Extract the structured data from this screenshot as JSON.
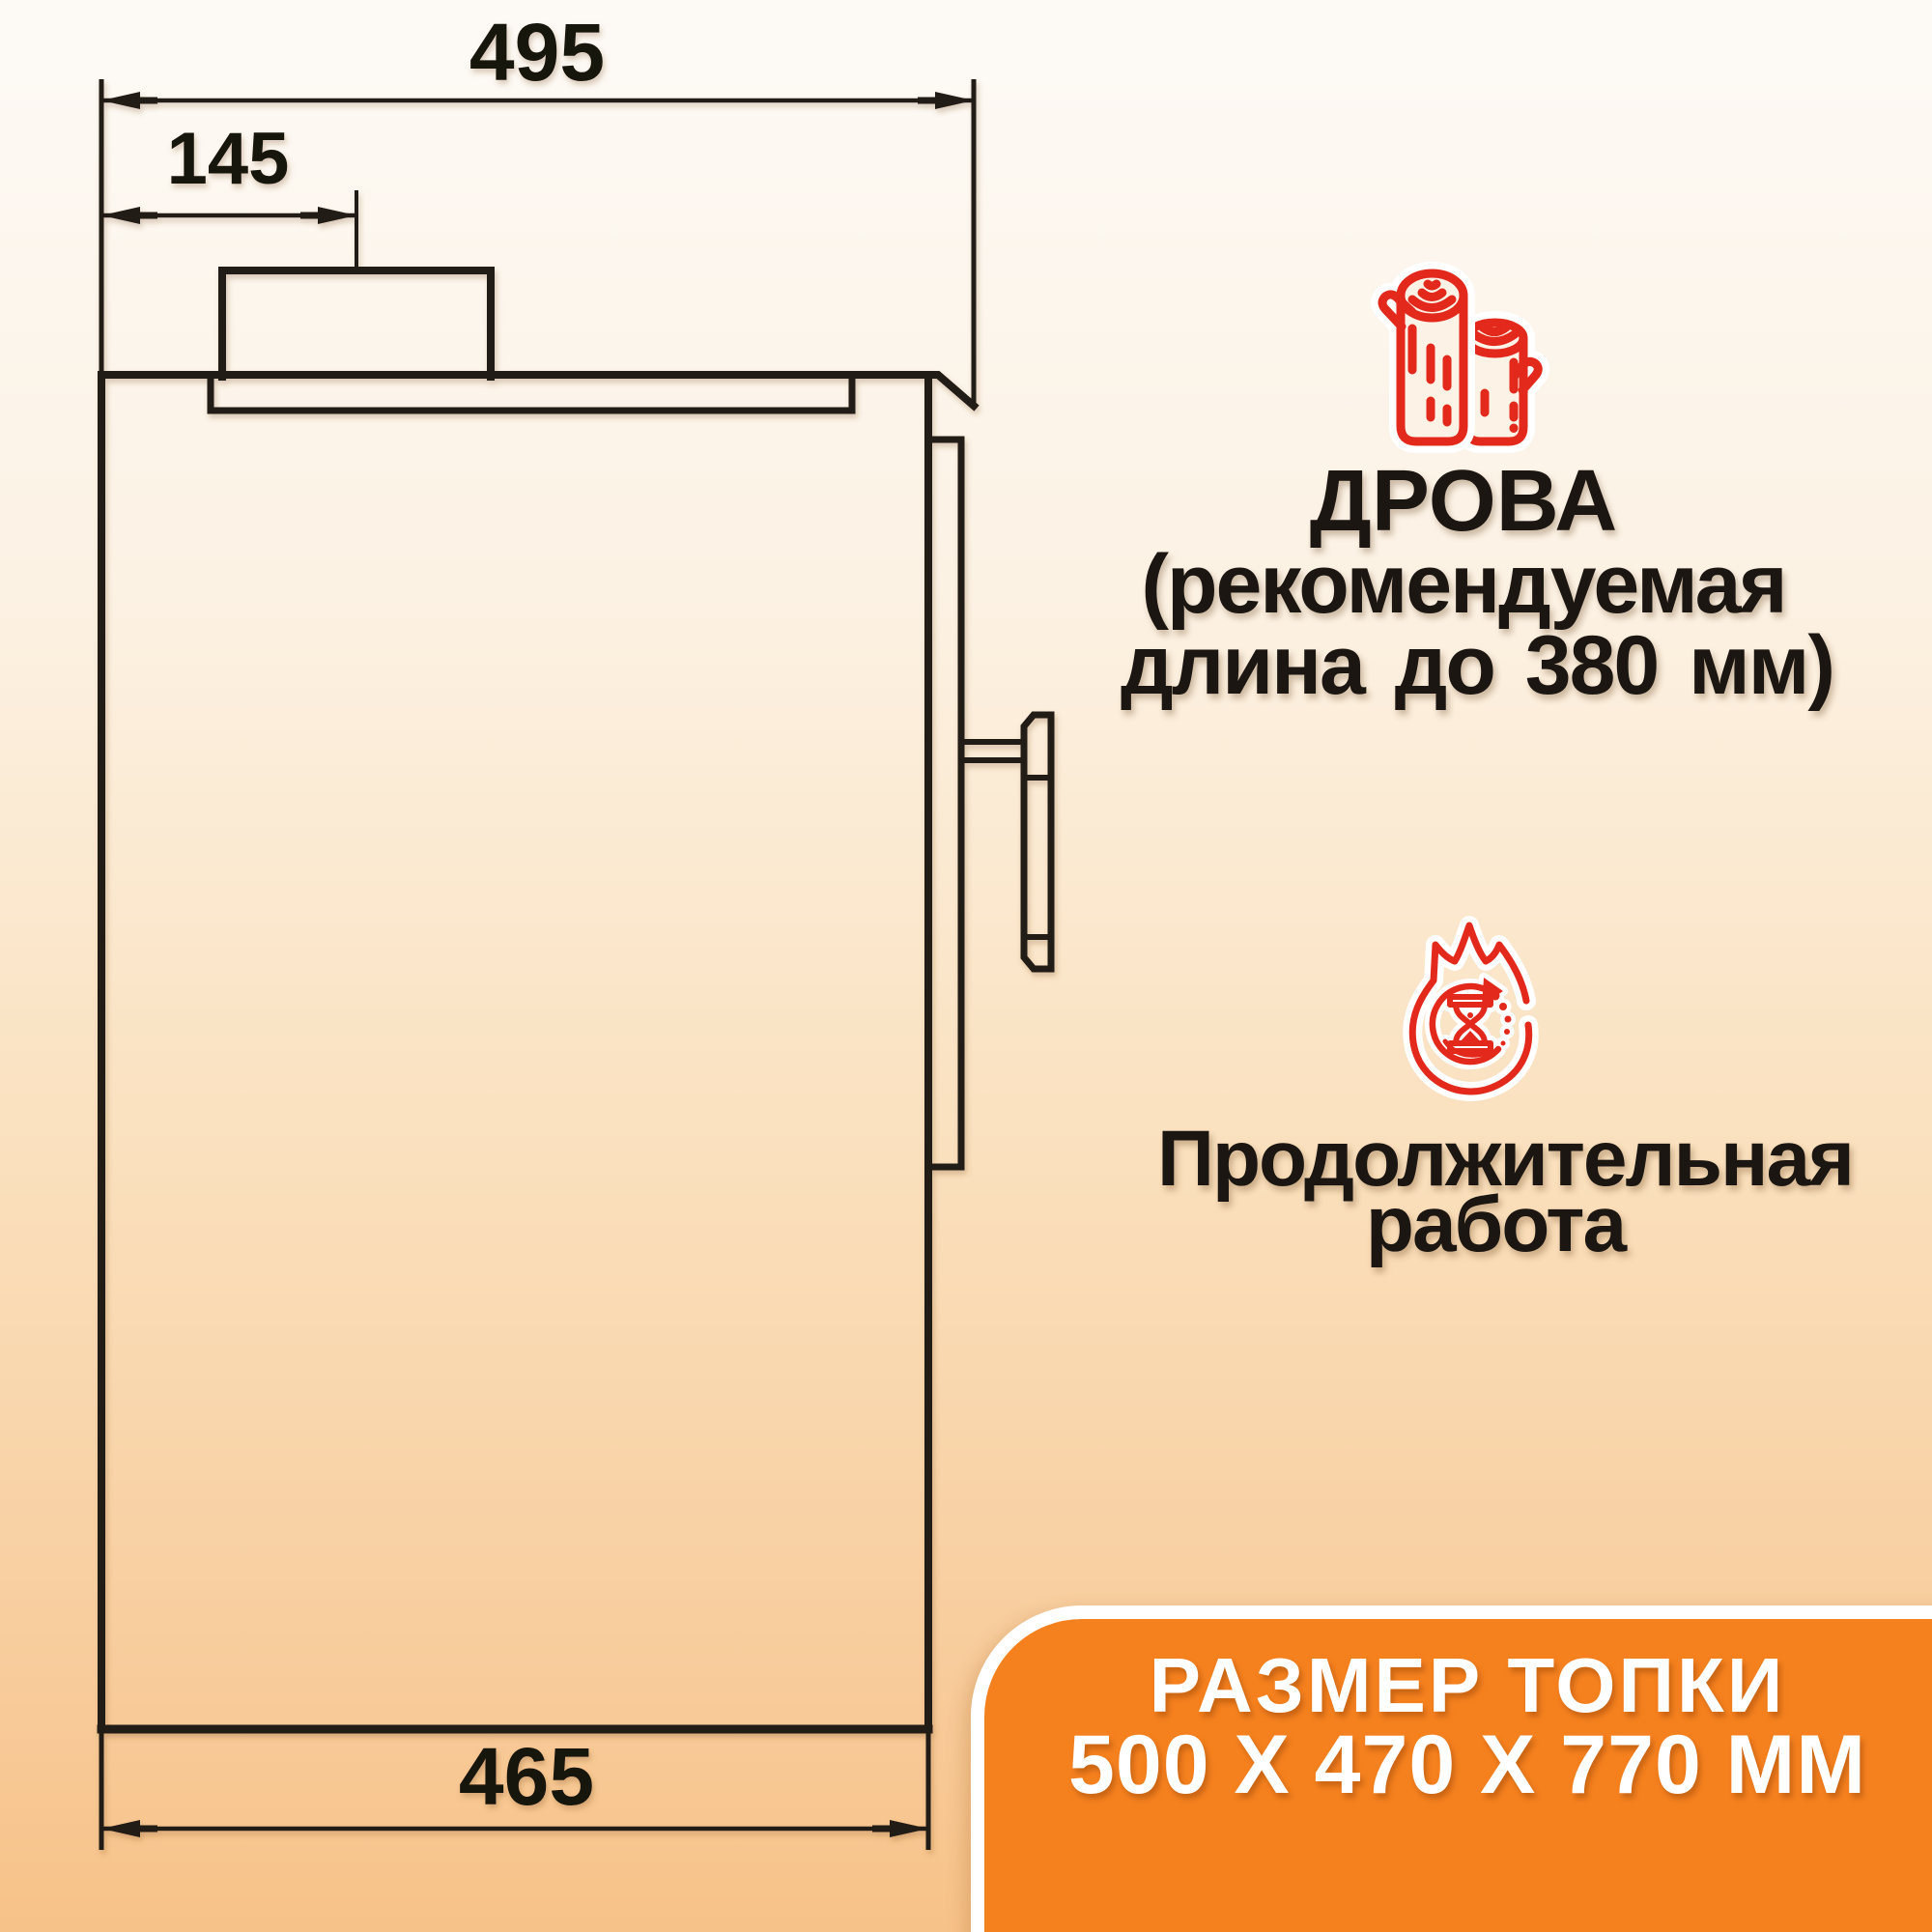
{
  "dimensions": {
    "top_width_label": "495",
    "chimney_offset_label": "145",
    "bottom_width_label": "465"
  },
  "features": {
    "firewood": {
      "icon": "logs-icon",
      "title": "ДРОВА",
      "subtitle_line1": "(рекомендуемая",
      "subtitle_line2": "длина до 380 мм)"
    },
    "long_burn": {
      "icon": "flame-hourglass-icon",
      "line1": "Продолжительная",
      "line2": "работа"
    }
  },
  "badge": {
    "line1": "РАЗМЕР ТОПКИ",
    "line2": "500 Х 470 Х 770 ММ"
  },
  "colors": {
    "accent_orange": "#f5811e",
    "icon_red": "#e2291c",
    "line_black": "#201a14",
    "badge_text": "#ffffff"
  }
}
